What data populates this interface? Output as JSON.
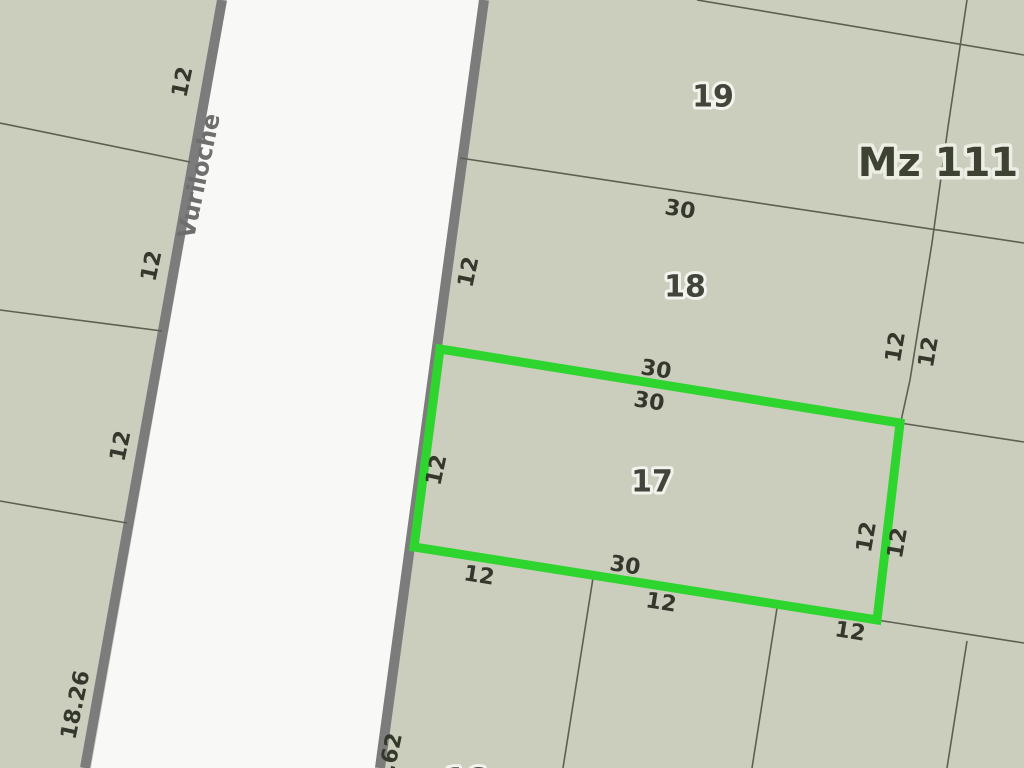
{
  "map": {
    "block_label": "Mz 111",
    "street_name": "Vuriloche",
    "highlighted_parcel": "17",
    "colors": {
      "parcel_fill": "#cbcdbd",
      "street_fill": "#f8f8f6",
      "street_border": "#7c7c7c",
      "boundary_line": "#5c604f",
      "highlight_green": "#2ed52e",
      "label_dark": "#33372c",
      "street_name_gray": "#6e6e6e"
    },
    "labels": [
      {
        "kind": "street",
        "name": "street-name-label",
        "text": "Vuriloche",
        "x": 199,
        "y": 176,
        "rot": -78
      },
      {
        "kind": "parcel",
        "name": "parcel-number-19",
        "text": "19",
        "x": 713,
        "y": 97,
        "rot": 0
      },
      {
        "kind": "parcel",
        "name": "parcel-number-18",
        "text": "18",
        "x": 685,
        "y": 287,
        "rot": 0
      },
      {
        "kind": "parcel",
        "name": "parcel-number-17",
        "text": "17",
        "x": 652,
        "y": 482,
        "rot": 0
      },
      {
        "kind": "parcel",
        "name": "parcel-number-16-partial",
        "text": "16",
        "x": 466,
        "y": 780,
        "rot": 0
      },
      {
        "kind": "block",
        "name": "block-label",
        "text": "Mz 111",
        "x": 938,
        "y": 163,
        "rot": 0
      },
      {
        "kind": "dim",
        "name": "dimension-label",
        "text": "12",
        "x": 183,
        "y": 82,
        "rot": -78
      },
      {
        "kind": "dim",
        "name": "dimension-label",
        "text": "12",
        "x": 152,
        "y": 266,
        "rot": -78
      },
      {
        "kind": "dim",
        "name": "dimension-label",
        "text": "12",
        "x": 121,
        "y": 446,
        "rot": -78
      },
      {
        "kind": "dim",
        "name": "dimension-label",
        "text": "18.26",
        "x": 76,
        "y": 705,
        "rot": -78
      },
      {
        "kind": "dim",
        "name": "dimension-label",
        "text": "4.62",
        "x": 390,
        "y": 760,
        "rot": -78
      },
      {
        "kind": "dim",
        "name": "dimension-label",
        "text": "12",
        "x": 469,
        "y": 272,
        "rot": -78
      },
      {
        "kind": "dim",
        "name": "dimension-label",
        "text": "12",
        "x": 437,
        "y": 470,
        "rot": -78
      },
      {
        "kind": "dim",
        "name": "dimension-label",
        "text": "30",
        "x": 680,
        "y": 210,
        "rot": 9
      },
      {
        "kind": "dim",
        "name": "dimension-label",
        "text": "30",
        "x": 656,
        "y": 370,
        "rot": 9
      },
      {
        "kind": "dim",
        "name": "dimension-label",
        "text": "30",
        "x": 649,
        "y": 402,
        "rot": 9
      },
      {
        "kind": "dim",
        "name": "dimension-label",
        "text": "30",
        "x": 625,
        "y": 566,
        "rot": 9
      },
      {
        "kind": "dim",
        "name": "dimension-label",
        "text": "12",
        "x": 479,
        "y": 576,
        "rot": 9
      },
      {
        "kind": "dim",
        "name": "dimension-label",
        "text": "12",
        "x": 661,
        "y": 603,
        "rot": 9
      },
      {
        "kind": "dim",
        "name": "dimension-label",
        "text": "12",
        "x": 850,
        "y": 632,
        "rot": 9
      },
      {
        "kind": "dim",
        "name": "dimension-label",
        "text": "12",
        "x": 896,
        "y": 347,
        "rot": -80
      },
      {
        "kind": "dim",
        "name": "dimension-label",
        "text": "12",
        "x": 929,
        "y": 352,
        "rot": -80
      },
      {
        "kind": "dim",
        "name": "dimension-label",
        "text": "12",
        "x": 867,
        "y": 537,
        "rot": -80
      },
      {
        "kind": "dim",
        "name": "dimension-label",
        "text": "12",
        "x": 898,
        "y": 543,
        "rot": -80
      }
    ]
  }
}
